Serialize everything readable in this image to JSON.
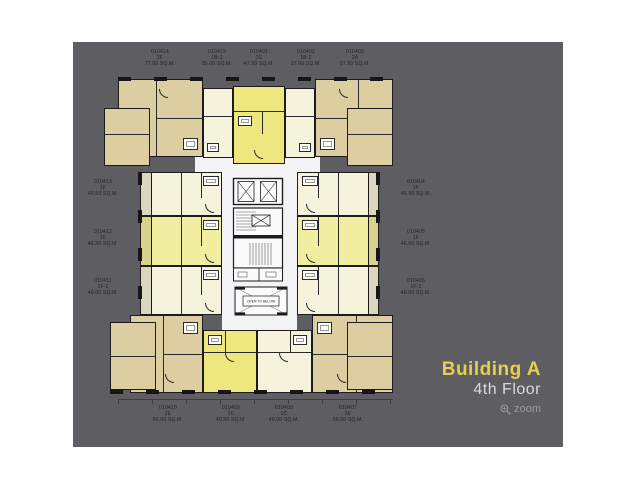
{
  "branding": {
    "building": "Building A",
    "floor": "4th Floor",
    "zoom_label": "zoom"
  },
  "plan": {
    "core": {
      "open_to_below": "OPEN TO BELOW"
    },
    "units": [
      {
        "id": "010414",
        "type": "2F",
        "area": "77.00 SQ.M.",
        "side": "top"
      },
      {
        "id": "010415",
        "type": "1B-1",
        "area": "35.00 SQ.M.",
        "side": "top"
      },
      {
        "id": "010401",
        "type": "1G",
        "area": "47.50 SQ.M.",
        "side": "top"
      },
      {
        "id": "010402",
        "type": "1B-2",
        "area": "37.00 SQ.M.",
        "side": "top"
      },
      {
        "id": "010403",
        "type": "2A",
        "area": "57.50 SQ.M.",
        "side": "top"
      },
      {
        "id": "010413",
        "type": "1F",
        "area": "46.50 SQ.M.",
        "side": "left"
      },
      {
        "id": "010412",
        "type": "1F",
        "area": "46.50 SQ.M.",
        "side": "left"
      },
      {
        "id": "010411",
        "type": "1F-1",
        "area": "46.00 SQ.M.",
        "side": "left"
      },
      {
        "id": "010404",
        "type": "1F",
        "area": "46.50 SQ.M.",
        "side": "right"
      },
      {
        "id": "010405",
        "type": "1F",
        "area": "46.50 SQ.M.",
        "side": "right"
      },
      {
        "id": "010406",
        "type": "1F-1",
        "area": "46.00 SQ.M.",
        "side": "right"
      },
      {
        "id": "010410",
        "type": "2E",
        "area": "66.00 SQ.M.",
        "side": "bottom"
      },
      {
        "id": "010409",
        "type": "1C",
        "area": "40.50 SQ.M.",
        "side": "bottom"
      },
      {
        "id": "010408",
        "type": "1C",
        "area": "40.00 SQ.M.",
        "side": "bottom"
      },
      {
        "id": "010407",
        "type": "2E",
        "area": "66.00 SQ.M.",
        "side": "bottom"
      }
    ],
    "colors": {
      "background_gray": "#5E5E62",
      "unit_tan": "#DDCEA2",
      "unit_cream": "#F5F3DC",
      "unit_yellow_bright": "#EDE77E",
      "unit_yellow_light": "#F1EEA2",
      "corridor_white": "#F3F3F5",
      "wall_black": "#1C1C1E",
      "brand_yellow": "#E5D049",
      "brand_gray": "#D9D9D9",
      "zoom_gray": "#9C9C9C"
    }
  }
}
